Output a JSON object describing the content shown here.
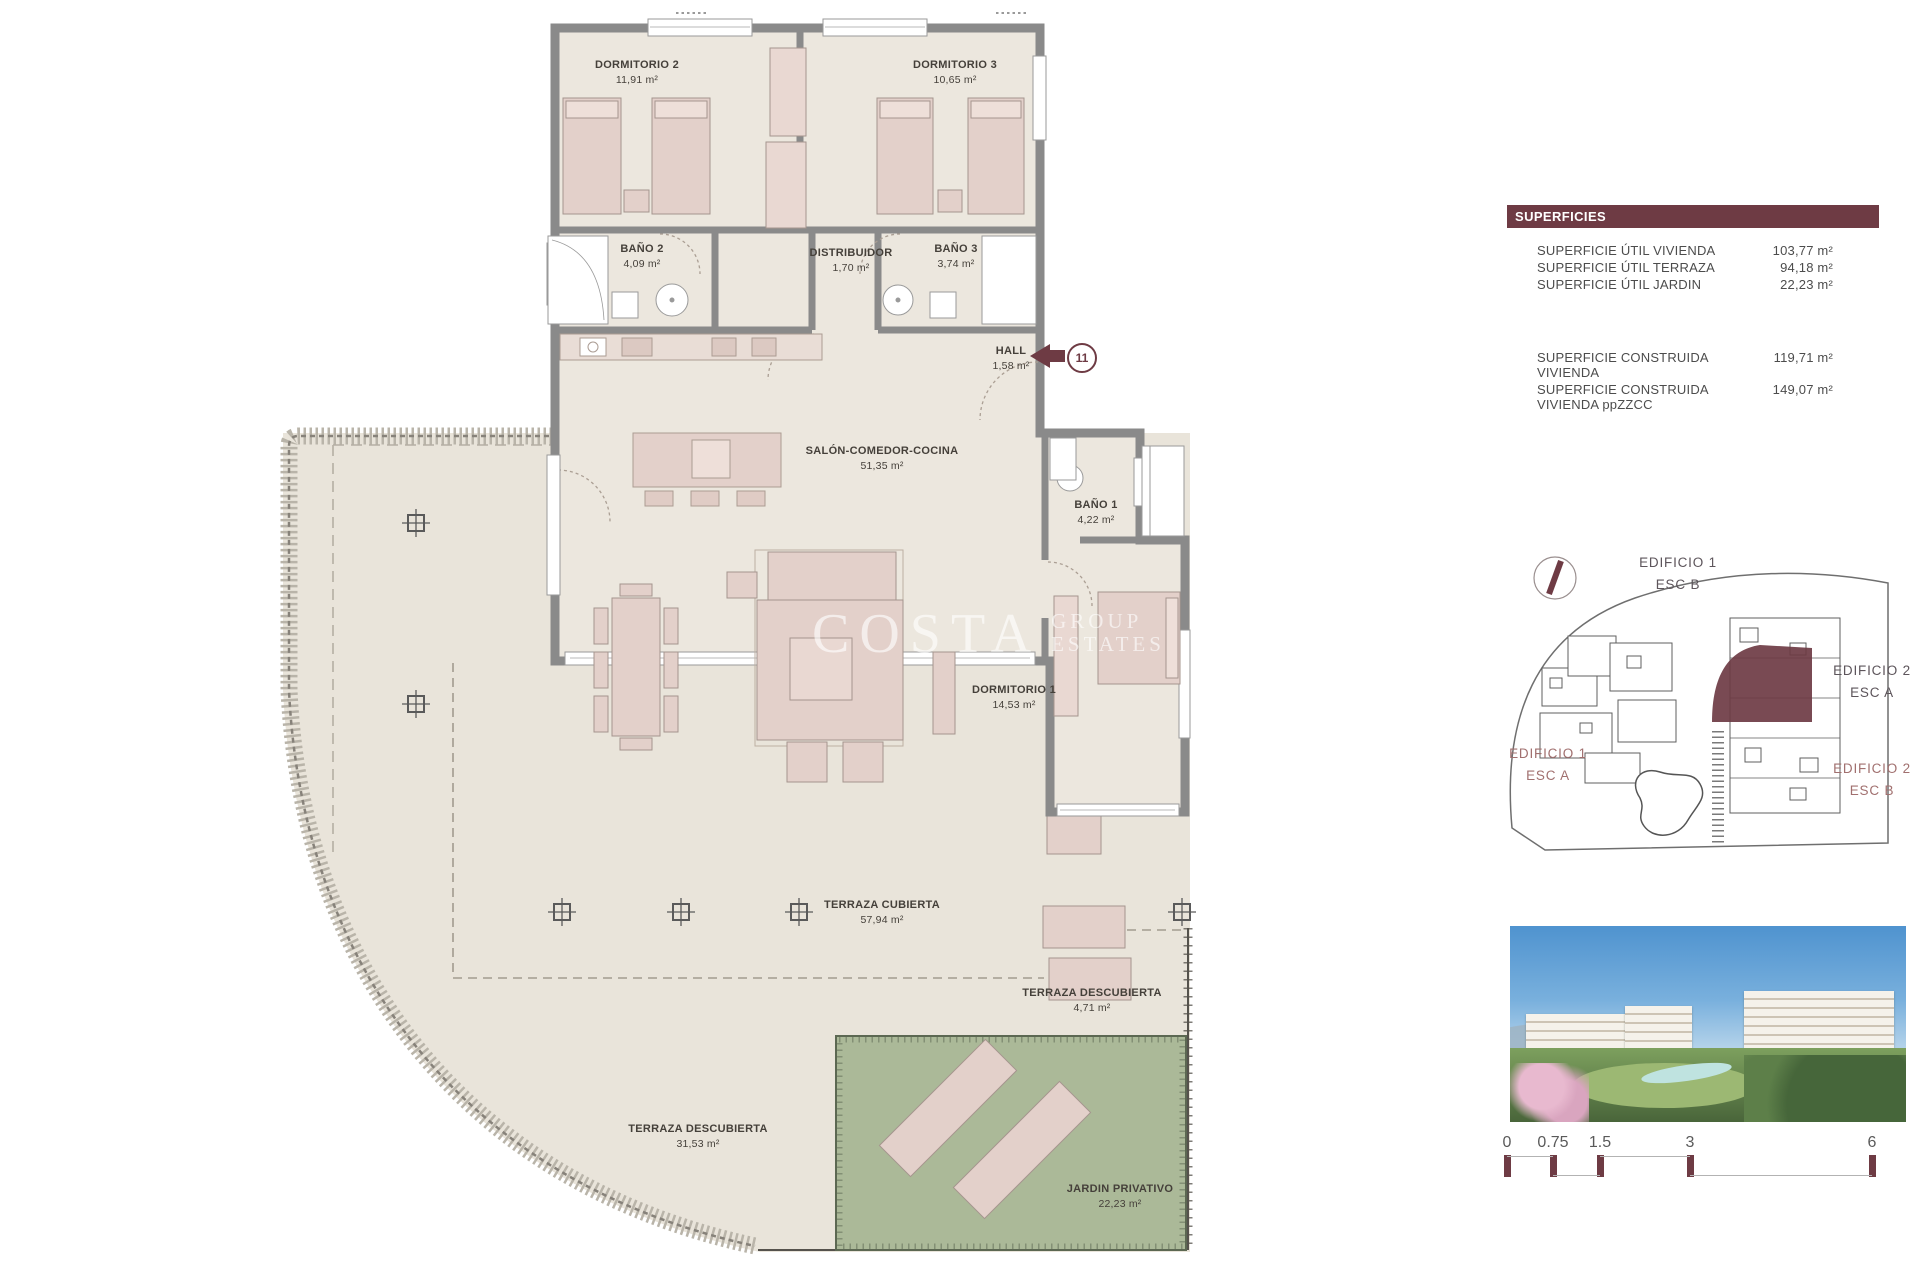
{
  "watermark": {
    "line1": "COSTA",
    "line2": "GROUP",
    "line3": "ESTATES"
  },
  "unit_marker": {
    "number": "11"
  },
  "rooms": {
    "dormitorio2": {
      "name": "DORMITORIO 2",
      "area": "11,91 m²"
    },
    "dormitorio3": {
      "name": "DORMITORIO 3",
      "area": "10,65 m²"
    },
    "bano2": {
      "name": "BAÑO 2",
      "area": "4,09 m²"
    },
    "distribuidor": {
      "name": "DISTRIBUIDOR",
      "area": "1,70 m²"
    },
    "bano3": {
      "name": "BAÑO 3",
      "area": "3,74 m²"
    },
    "hall": {
      "name": "HALL",
      "area": "1,58 m²"
    },
    "salon": {
      "name": "SALÓN-COMEDOR-COCINA",
      "area": "51,35 m²"
    },
    "bano1": {
      "name": "BAÑO 1",
      "area": "4,22 m²"
    },
    "dormitorio1": {
      "name": "DORMITORIO 1",
      "area": "14,53 m²"
    },
    "terraza_cubierta": {
      "name": "TERRAZA CUBIERTA",
      "area": "57,94 m²"
    },
    "terraza_descubierta_small": {
      "name": "TERRAZA DESCUBIERTA",
      "area": "4,71 m²"
    },
    "terraza_descubierta_large": {
      "name": "TERRAZA DESCUBIERTA",
      "area": "31,53 m²"
    },
    "jardin": {
      "name": "JARDIN PRIVATIVO",
      "area": "22,23 m²"
    }
  },
  "superficies": {
    "title": "SUPERFICIES",
    "rows": [
      {
        "label": "SUPERFICIE ÚTIL VIVIENDA",
        "value": "103,77 m²"
      },
      {
        "label": "SUPERFICIE ÚTIL TERRAZA",
        "value": "94,18 m²"
      },
      {
        "label": "SUPERFICIE ÚTIL JARDIN",
        "value": "22,23 m²"
      },
      {
        "label": "SUPERFICIE CONSTRUIDA VIVIENDA",
        "value": "119,71 m²"
      },
      {
        "label": "SUPERFICIE CONSTRUIDA VIVIENDA ppZZCC",
        "value": "149,07 m²"
      }
    ]
  },
  "site_plan": {
    "labels": [
      {
        "building": "EDIFICIO 1",
        "stair": "ESC B"
      },
      {
        "building": "EDIFICIO 2",
        "stair": "ESC A"
      },
      {
        "building": "EDIFICIO 1",
        "stair": "ESC A"
      },
      {
        "building": "EDIFICIO 2",
        "stair": "ESC B"
      }
    ]
  },
  "scale_bar": {
    "labels": [
      "0",
      "0.75",
      "1.5",
      "3",
      "6"
    ]
  },
  "colors": {
    "accent": "#6e3b44",
    "wall": "#8a8a8a",
    "floor": "#ece7de",
    "terrace": "#e9e4da",
    "furniture": "#e3d0ca",
    "garden": "#abb998"
  }
}
